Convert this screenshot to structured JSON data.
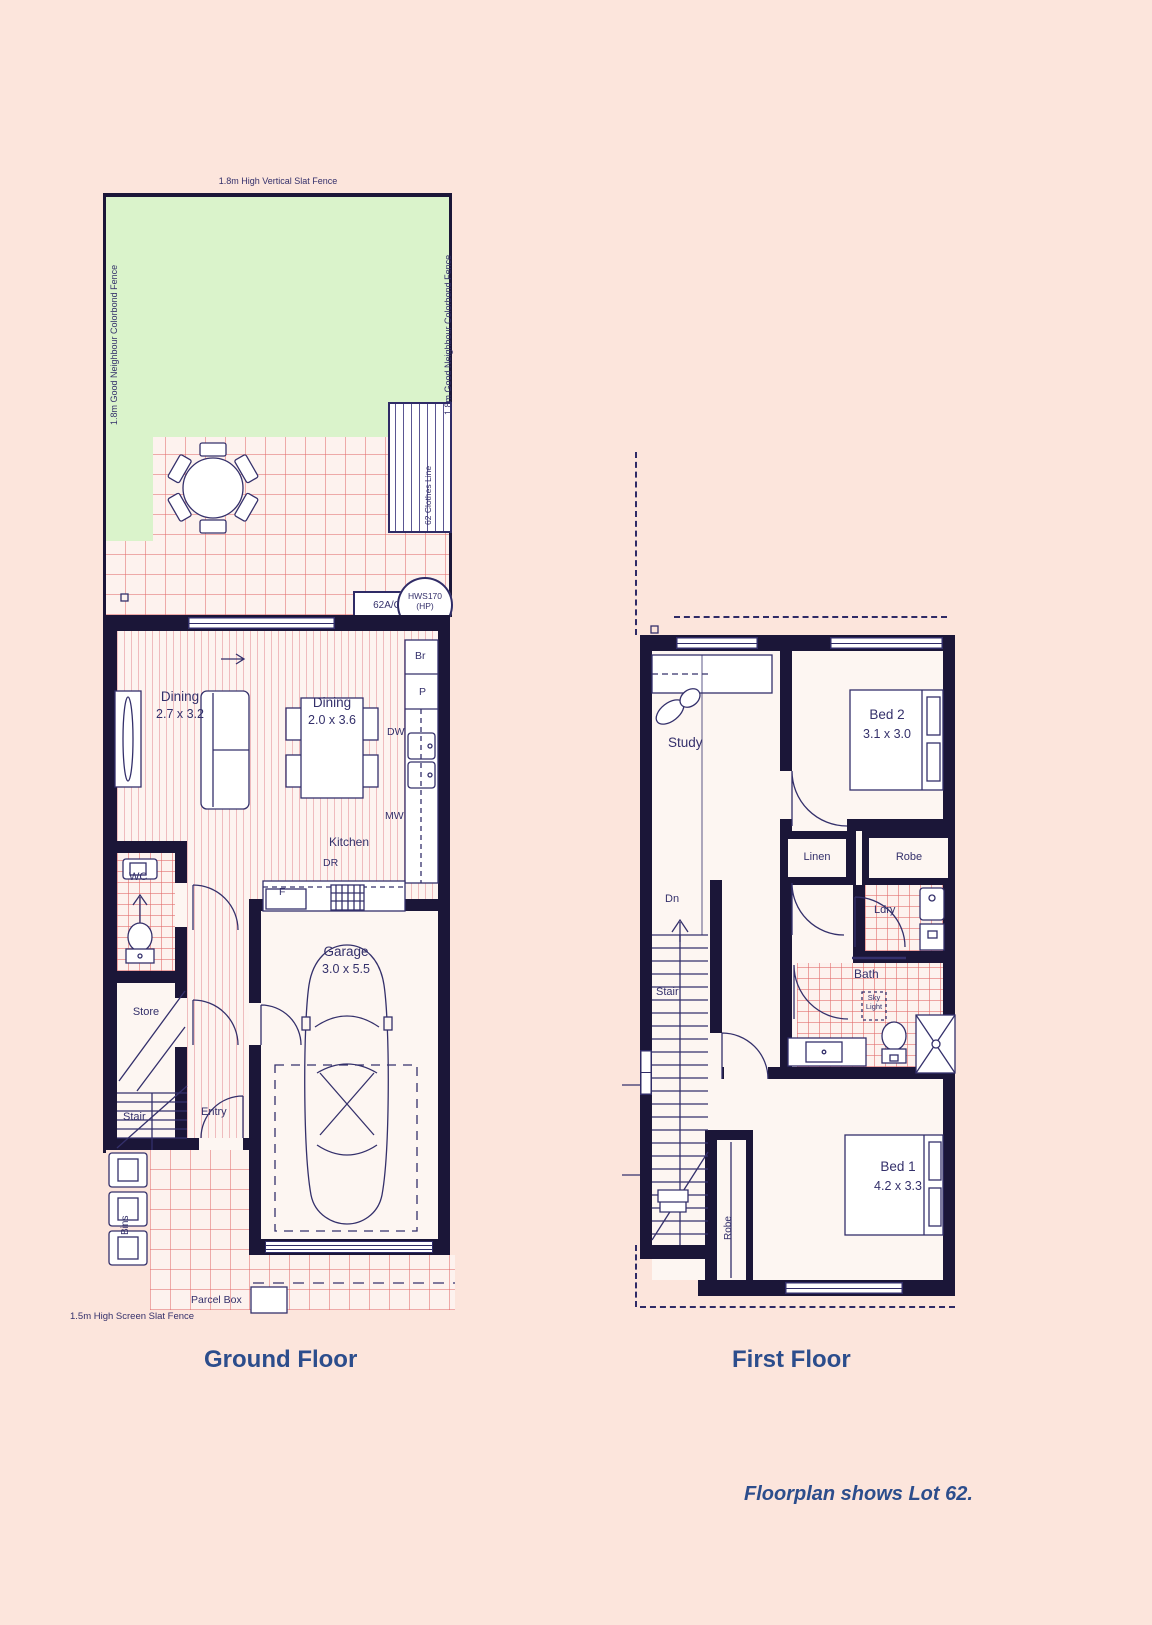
{
  "colors": {
    "background": "#fce5dc",
    "wall": "#1b1638",
    "line": "#34306b",
    "grass": "#daf3cb",
    "grid_pink": "#e26e6e",
    "title_blue": "#2c4d8c"
  },
  "ground_floor": {
    "title": "Ground Floor",
    "fence_top": "1.8m High Vertical Slat Fence",
    "fence_left": "1.8m Good Neighbour Colorbond Fence",
    "fence_right": "1.8m Good Neighbour Colorbond Fence",
    "fence_bottom": "1.5m High Screen Slat Fence",
    "clothes_line": "62 Clothes Line",
    "ac_unit": "62A/C",
    "hws_line1": "HWS170",
    "hws_line2": "(HP)",
    "living": {
      "name": "Dining",
      "dims": "2.7 x 3.2"
    },
    "dining": {
      "name": "Dining",
      "dims": "2.0 x 3.6"
    },
    "kitchen": "Kitchen",
    "labels": {
      "br": "Br",
      "p": "P",
      "dw": "DW",
      "mw": "MW",
      "dr": "DR",
      "f": "F"
    },
    "wc": "WC",
    "store": "Store",
    "stair": "Stair",
    "entry": "Entry",
    "garage": {
      "name": "Garage",
      "dims": "3.0 x 5.5"
    },
    "bins": "Bins",
    "parcel_box": "Parcel Box"
  },
  "first_floor": {
    "title": "First Floor",
    "study": "Study",
    "bed2": {
      "name": "Bed 2",
      "dims": "3.1 x 3.0"
    },
    "linen": "Linen",
    "robe_bed2": "Robe",
    "ldry": "Ldry",
    "bath": "Bath",
    "skylight_line1": "Sky",
    "skylight_line2": "Light",
    "dn": "Dn",
    "stair": "Stair",
    "robe_bed1": "Robe",
    "bed1": {
      "name": "Bed 1",
      "dims": "4.2 x 3.3"
    }
  },
  "caption": "Floorplan shows Lot 62."
}
